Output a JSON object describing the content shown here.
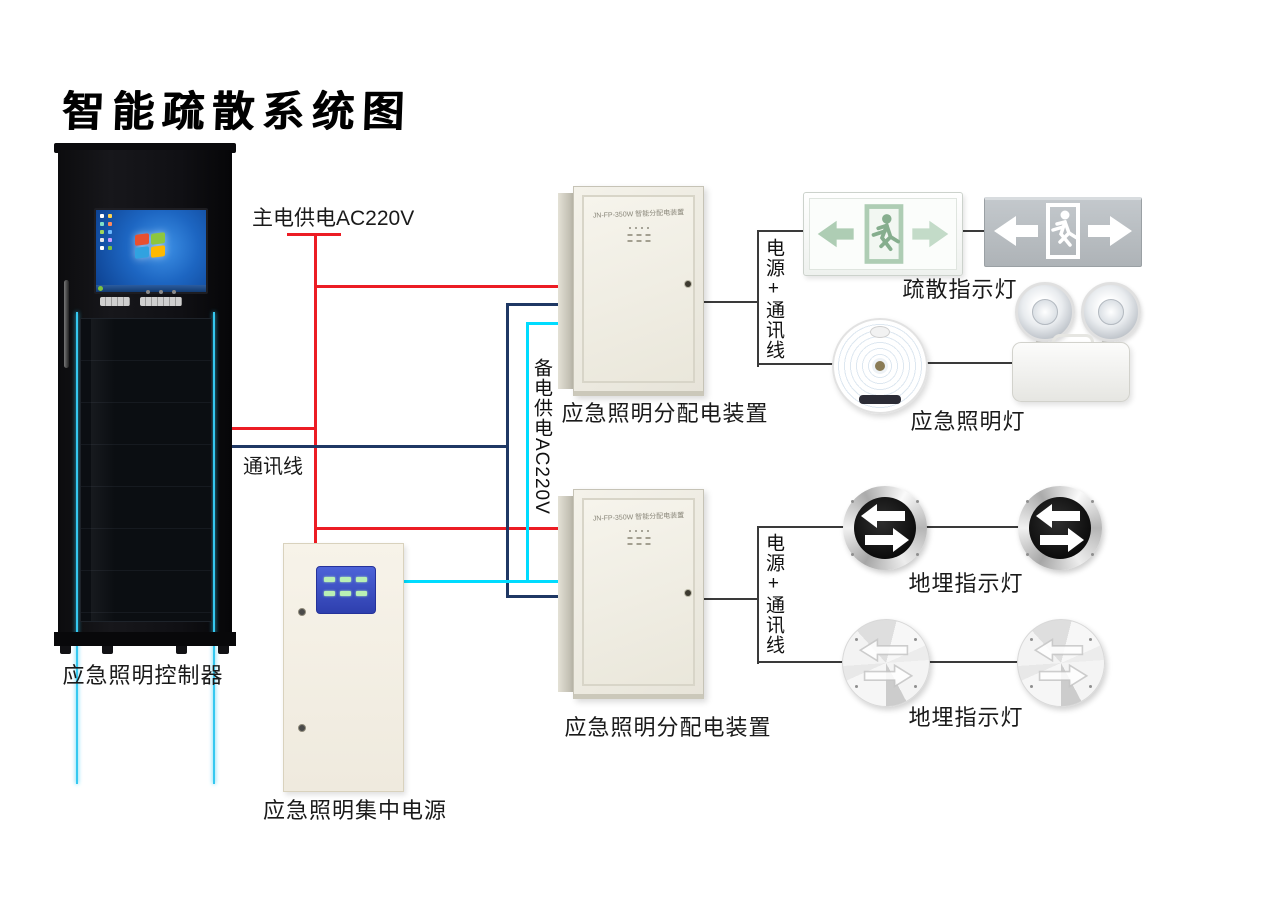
{
  "title": "智能疏散系统图",
  "colors": {
    "main_power_line": "#ec1c24",
    "comm_line": "#1f3864",
    "backup_line": "#00dcff",
    "device_line": "#3a3a3a",
    "cabinet_stripe": "#35c8f0"
  },
  "cabinet": {
    "label": "应急照明控制器"
  },
  "power_box": {
    "label": "应急照明集中电源"
  },
  "boxes": {
    "model_text": "JN-FP-350W 智能分配电装置",
    "box1_label": "应急照明分配电装置",
    "box2_label": "应急照明分配电装置"
  },
  "wires": {
    "main_power": "主电供电AC220V",
    "comm": "通讯线",
    "backup": "备电供电AC220V",
    "power_comm_1": "电源+通讯线",
    "power_comm_2": "电源+通讯线"
  },
  "devices": {
    "evac_sign_label": "疏散指示灯",
    "emergency_lamp_label": "应急照明灯",
    "ground_lamp_label_1": "地埋指示灯",
    "ground_lamp_label_2": "地埋指示灯"
  },
  "icons": {
    "left_arrow": "←",
    "right_arrow": "→",
    "running_man": "🏃",
    "double_arrow": "⇄"
  }
}
